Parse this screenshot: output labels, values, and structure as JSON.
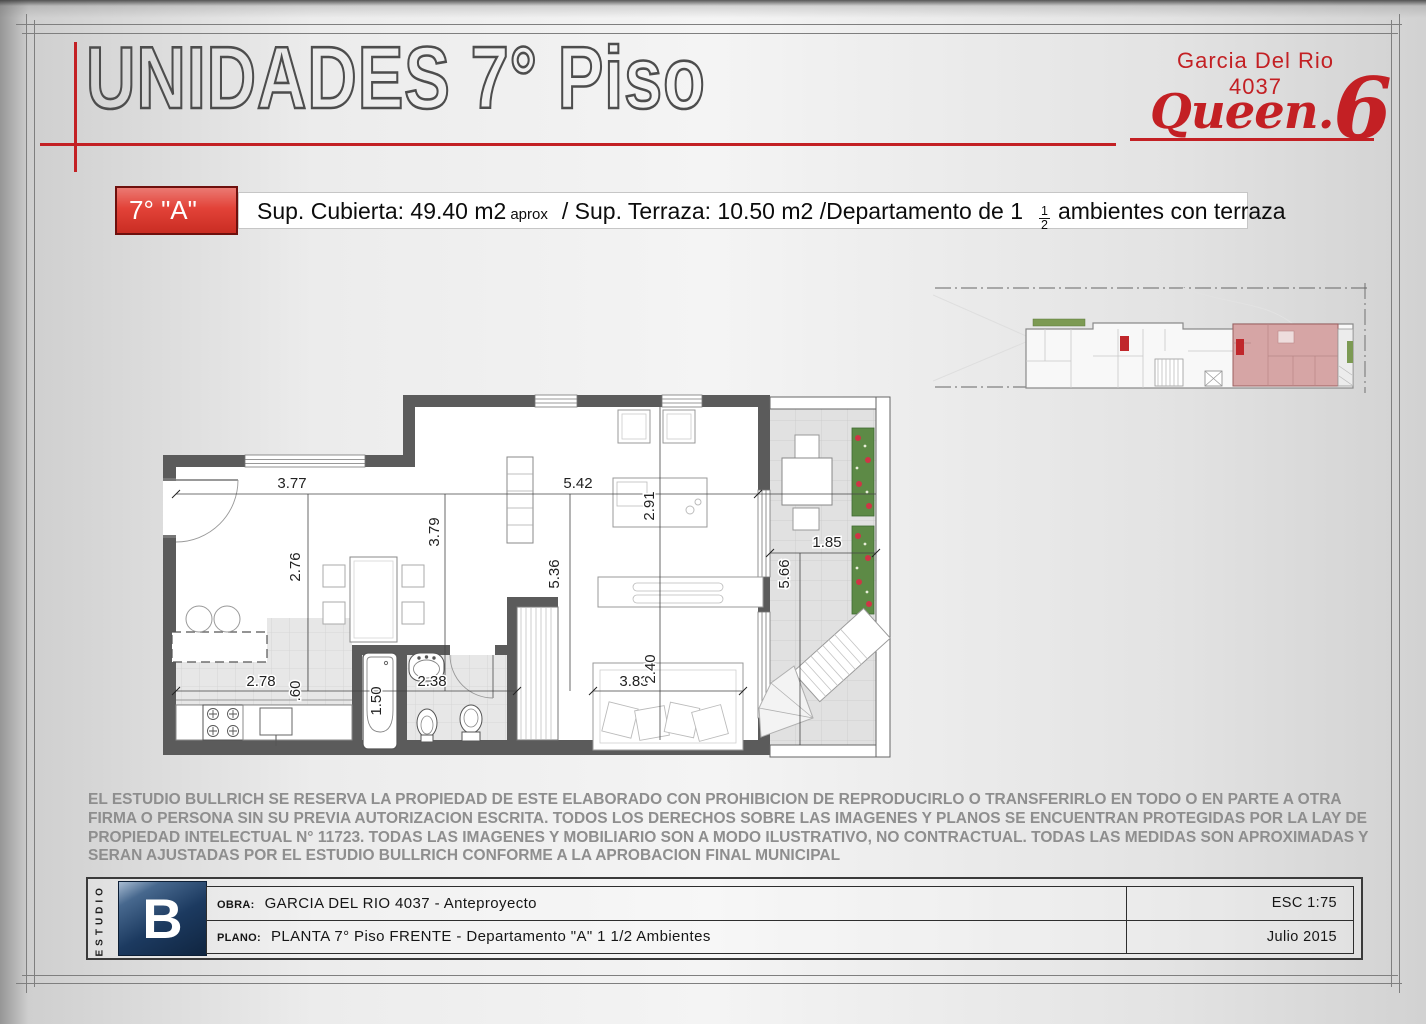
{
  "colors": {
    "accent_red": "#c32024",
    "box_red": "#e03227",
    "wall_gray": "#5b5b5b",
    "logo_blue": "#1c3a60",
    "highlight_pink": "#d5a4a4",
    "tile_gray": "#e7e7e7"
  },
  "header": {
    "title": "UNIDADES 7° Piso",
    "brand_line1": "Garcia Del Rio",
    "brand_line2": "4037",
    "brand_script": "Queen.",
    "brand_number": "6"
  },
  "unit": {
    "tag": "7° \"A\"",
    "spec_main": "Sup. Cubierta: 49.40 m2",
    "spec_aprox": "aprox",
    "spec_mid": "/ Sup. Terraza: 10.50 m2 /Departamento de 1",
    "frac_top": "1",
    "frac_bottom": "2",
    "spec_end": "ambientes con terraza"
  },
  "plan": {
    "dims": {
      "w377": "3.77",
      "w542": "5.42",
      "w185": "1.85",
      "w291": "2.91",
      "w276": "2.76",
      "w379": "3.79",
      "w536": "5.36",
      "w566": "5.66",
      "w278": "2.78",
      "w060": ".60",
      "w150": "1.50",
      "w238": "2.38",
      "w383": "3.83",
      "w240": "2.40"
    }
  },
  "disclaimer": {
    "lines": [
      "EL ESTUDIO BULLRICH SE RESERVA LA PROPIEDAD DE ESTE ELABORADO CON PROHIBICION DE REPRODUCIRLO O TRANSFERIRLO EN TODO O EN PARTE A OTRA",
      "FIRMA O PERSONA SIN SU PREVIA AUTORIZACION ESCRITA. TODOS LOS DERECHOS SOBRE LAS IMAGENES Y PLANOS SE ENCUENTRAN PROTEGIDAS POR LA LAY DE",
      "PROPIEDAD INTELECTUAL N° 11723.  TODAS LAS IMAGENES Y MOBILIARIO SON A MODO ILUSTRATIVO, NO CONTRACTUAL. TODAS LAS MEDIDAS SON APROXIMADAS Y",
      "SERAN AJUSTADAS POR EL ESTUDIO BULLRICH CONFORME A LA APROBACION FINAL MUNICIPAL"
    ]
  },
  "titleblock": {
    "studio_vertical": "ESTUDIO",
    "logo_letter": "B",
    "obra_label": "OBRA:",
    "obra_value": "GARCIA DEL RIO 4037 - Anteproyecto",
    "plano_label": "PLANO:",
    "plano_value": "PLANTA 7° Piso FRENTE - Departamento \"A\" 1 1/2 Ambientes",
    "scale": "ESC 1:75",
    "date": "Julio 2015"
  }
}
